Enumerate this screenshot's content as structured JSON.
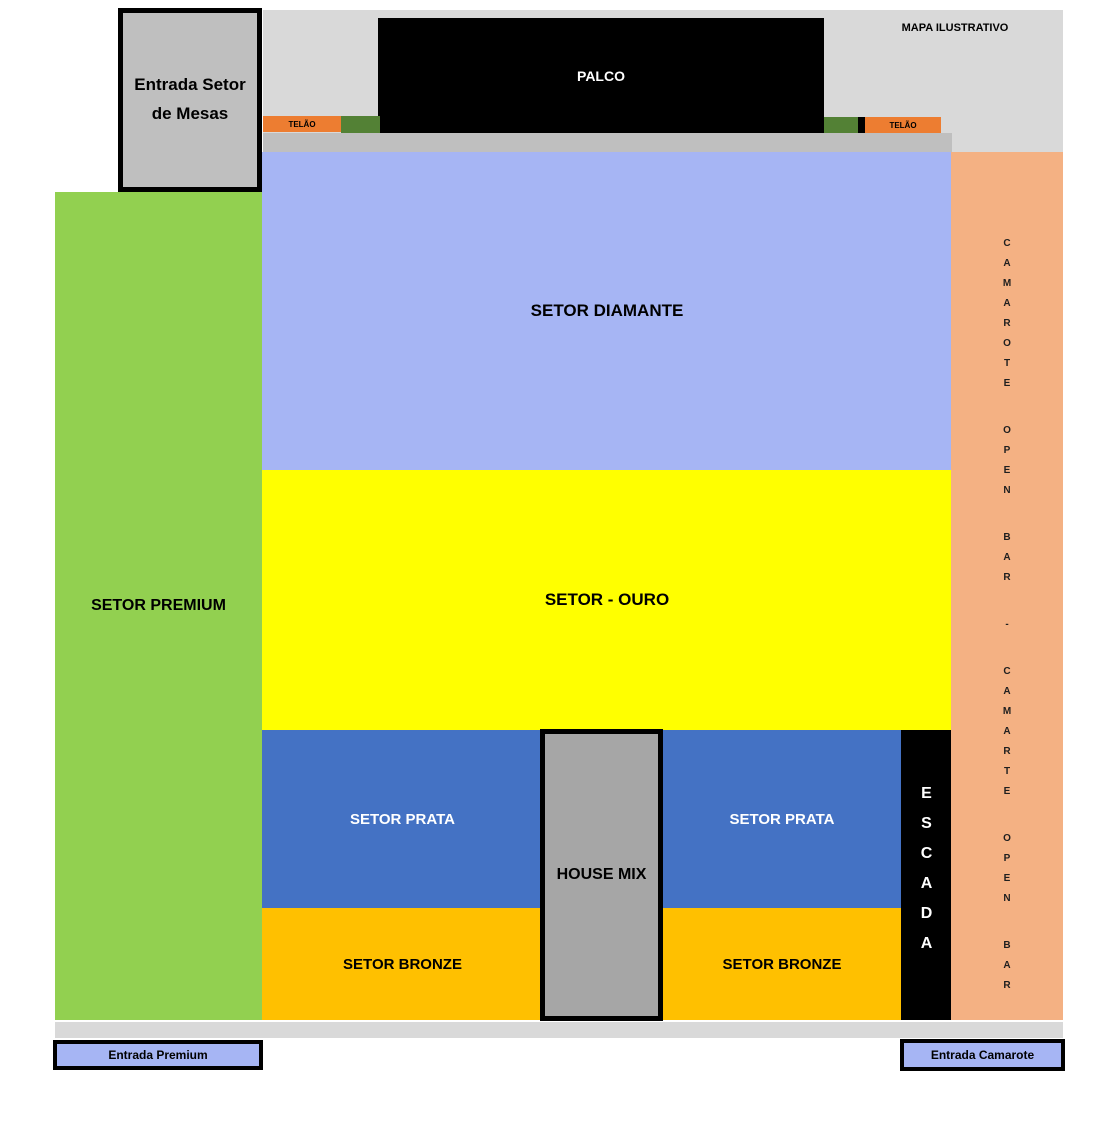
{
  "title": "MAPA ILUSTRATIVO",
  "stage": {
    "palco": "PALCO",
    "telao_left": "TELÃO",
    "telao_right": "TELÃO"
  },
  "sectors": {
    "premium": "SETOR PREMIUM",
    "diamante": "SETOR DIAMANTE",
    "ouro": "SETOR - OURO",
    "prata_left": "SETOR PRATA",
    "prata_right": "SETOR PRATA",
    "bronze_left": "SETOR BRONZE",
    "bronze_right": "SETOR BRONZE",
    "house_mix": "HOUSE MIX",
    "escada": "ESCADA",
    "camarote_strip": "CAMAROTE OPEN BAR - CAMARTE OPEN BAR"
  },
  "entrances": {
    "mesas_line1": "Entrada Setor",
    "mesas_line2": "de Mesas",
    "premium": "Entrada Premium",
    "camarote": "Entrada Camarote"
  },
  "colors": {
    "premium_green": "#92d050",
    "diamante_blue": "#a6b5f4",
    "ouro_yellow": "#ffff00",
    "prata_blue": "#4472c4",
    "bronze_gold": "#ffc000",
    "camarote_salmon": "#f4b183",
    "telao_orange": "#ed7d31",
    "screen_green": "#538135",
    "stage_black": "#000000",
    "stage_bg_gray": "#d9d9d9",
    "apron_gray": "#bfbfbf",
    "house_mix_gray": "#a6a6a6",
    "entrance_blue": "#a6b5f4"
  }
}
